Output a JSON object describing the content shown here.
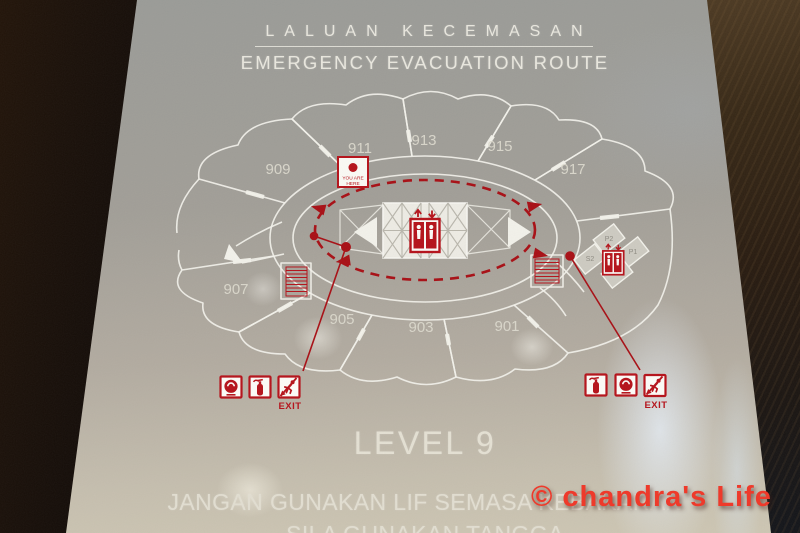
{
  "header": {
    "title_malay": "LALUAN KECEMASAN",
    "title_english": "EMERGENCY EVACUATION ROUTE"
  },
  "floor_plan": {
    "room_labels": [
      "909",
      "911",
      "913",
      "915",
      "917",
      "907",
      "905",
      "903",
      "901"
    ],
    "you_are_here": {
      "line1": "YOU ARE",
      "line2": "HERE"
    },
    "lift_bank_labels": [
      "P2",
      "P1",
      "S2",
      "S1"
    ],
    "exit_label": "EXIT"
  },
  "level": {
    "label": "LEVEL 9"
  },
  "footer": {
    "warning_line1": "JANGAN GUNAKAN LIF SEMASA KEBAKARAN",
    "warning_line2": "SILA GUNAKAN TANGGA"
  },
  "watermark": {
    "text": "© chandra's Life"
  },
  "colors": {
    "signal_red": "#b5121a",
    "route_red": "#a80f15",
    "panel_grey": "#a5a29a",
    "plan_line_white": "#f2f1ea",
    "watermark_red": "#ee3a2b",
    "frame_dark": "#1a1009"
  }
}
